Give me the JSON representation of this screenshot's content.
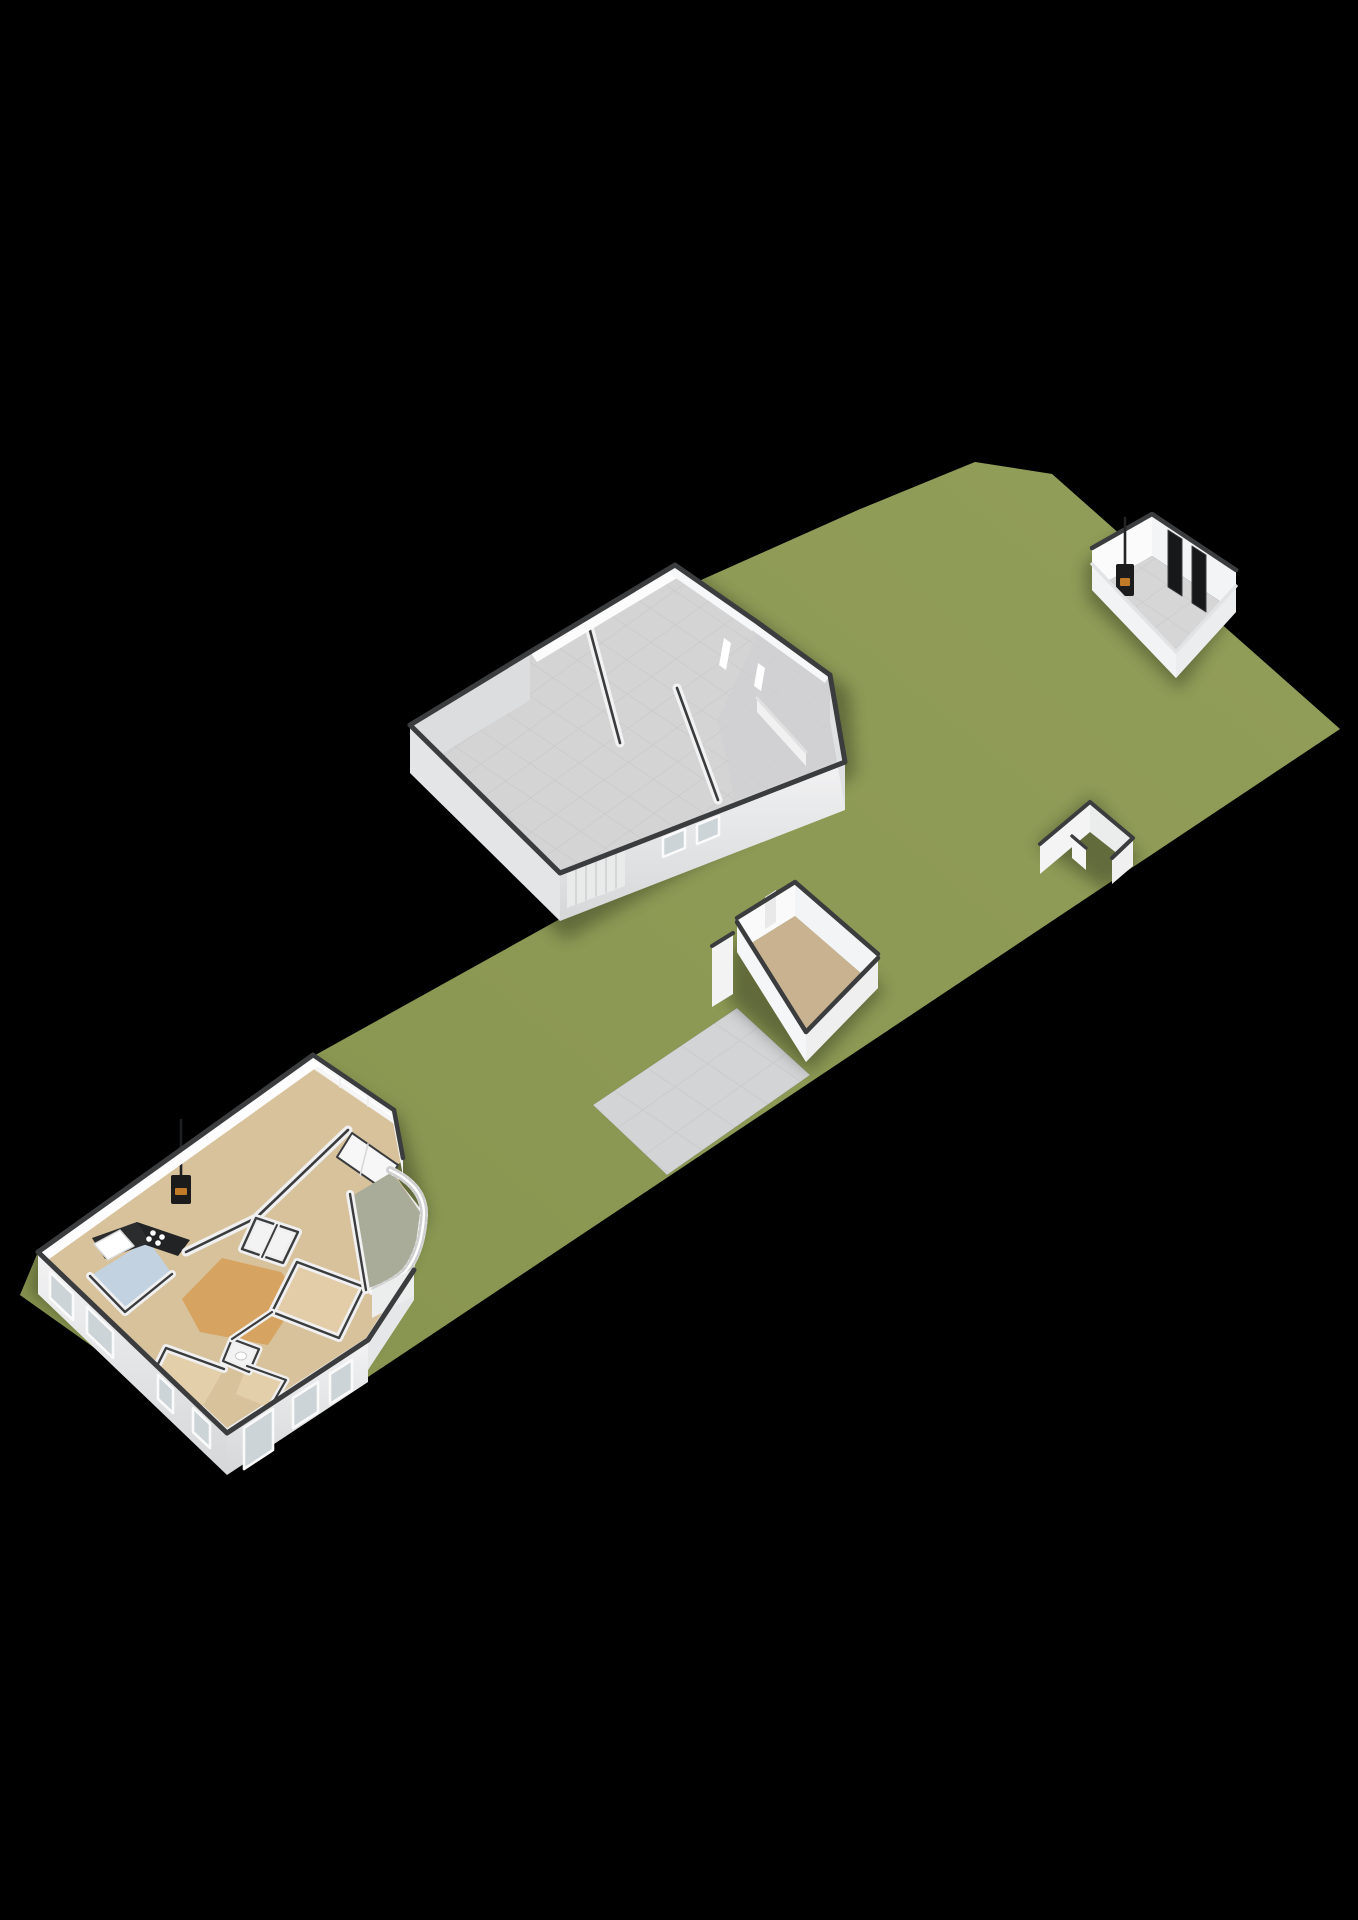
{
  "scene": {
    "title": "3D isometric site plan: elongated parcel with detached house, barn and garden buildings",
    "view": "isometric-3d-floorplan",
    "background": "#000000"
  },
  "palette": {
    "background": "#000000",
    "grass": "#87934a",
    "grassLight": "#8f9b51",
    "grassDark": "#6e7a38",
    "wallTop": "#3a3c3e",
    "wallWhite": "#fbfbfb",
    "wallInterior": "#f4f5f6",
    "wallLight": "#eff0f1",
    "wallShade": "#dcdddf",
    "wallShadeDark": "#cfd0d2",
    "baseSlab": "#ececed",
    "floorGrey": "#d4d4d5",
    "floorGreyDark": "#c9c9ca",
    "pavingGrey": "#d3d4d5",
    "floorTan": "#d8c29c",
    "floorTanLight": "#e3cda8",
    "floorTaupe": "#c8b28f",
    "floorOrange": "#d6a360",
    "floorBlue": "#c3d2e0",
    "floorSage": "#a9ac99",
    "glassGrey": "#ccd4d8",
    "stoveBlack": "#1b1b1b",
    "fireOrange": "#c07a28",
    "panelBlack": "#17181a",
    "railWhite": "#f3f3f3",
    "gardenRoomDoor": "#e9e9e9",
    "garageDoor": "#e9eaea",
    "garageDoorRib": "#d0d1d2"
  },
  "structures": {
    "parcel": {
      "label": "grass parcel",
      "shape": "elongated diagonal plot"
    },
    "path": {
      "label": "paved terrace path",
      "surface": "grey tiles"
    },
    "main_house": {
      "label": "main house",
      "rooms": [
        "living room",
        "kitchen",
        "bathroom",
        "hallway",
        "bedroom southeast",
        "bedroom south",
        "small bedroom",
        "toilet",
        "closets",
        "curved patio"
      ],
      "features": [
        "wood stove with flue",
        "black kitchen counter with hob",
        "bathtub",
        "curved white patio railing",
        "window openings",
        "glass wall to garden"
      ]
    },
    "barn": {
      "label": "large barn / garage",
      "features": [
        "grey concrete floor",
        "sectional garage door",
        "two small windows",
        "two slit windows",
        "annex room east"
      ]
    },
    "garden_house": {
      "label": "garden house northeast",
      "features": [
        "wood stove with flue",
        "two dark door panels",
        "grey tiled floor"
      ]
    },
    "garden_room": {
      "label": "garden room on terrace",
      "features": [
        "tan floor",
        "door in rear wall"
      ]
    },
    "storage_walls": {
      "label": "open storage walls southeast"
    }
  }
}
